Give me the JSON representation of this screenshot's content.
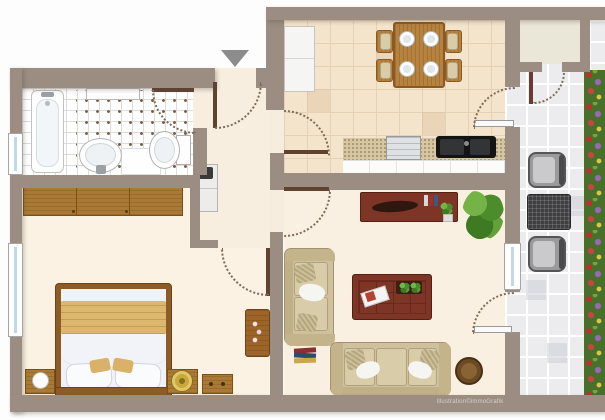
{
  "meta": {
    "type": "apartment-floor-plan",
    "watermark": "Illustration©immoGrafik",
    "entrance_marker": "down-arrow"
  },
  "palette": {
    "wall": "#9b8d81",
    "bathroom_tile": "#ffffff",
    "kitchen_floor": "#f5e4cc",
    "living_floor": "#faf0e1",
    "bedroom_floor": "#fbf2e4",
    "hallway_floor": "#f8eee0",
    "balcony_tile": "#ececef",
    "storage_niche_floor": "#eae6d8",
    "oak_wood": "#a97a35",
    "mahogany": "#7e3525",
    "sofa_fabric": "#cfc19d",
    "bed_blanket": "#dcb76e",
    "plant_green": "#4d8c2c",
    "door_leaf": "#5d4330",
    "window_glass": "#bdd9ea",
    "entrance_arrow": "#8c8c8c",
    "flower_colors": [
      "#b83232",
      "#9a68b8",
      "#d9c44c",
      "#49702a"
    ]
  },
  "rooms": [
    {
      "id": "bathroom",
      "fixtures": [
        "bathtub",
        "wash-basin",
        "toilet",
        "wall-shelf",
        "vanity",
        "window",
        "tiled-floor"
      ]
    },
    {
      "id": "hallway",
      "fixtures": [
        "entrance-door",
        "hallway-cabinet"
      ]
    },
    {
      "id": "kitchen-dining",
      "fixtures": [
        "dining-table",
        "dining-chair x4",
        "place-setting x4",
        "refrigerator",
        "counter",
        "stove",
        "sink",
        "balcony-door"
      ]
    },
    {
      "id": "living-room",
      "fixtures": [
        "sideboard",
        "houseplant",
        "loveseat",
        "sofa",
        "coffee-table",
        "round-side-table",
        "floor-books",
        "window",
        "balcony-door"
      ]
    },
    {
      "id": "bedroom",
      "fixtures": [
        "wardrobe",
        "double-bed",
        "nightstand x2",
        "bedside-lamp x2",
        "drawer-chest",
        "decor-table",
        "window"
      ]
    },
    {
      "id": "balcony",
      "fixtures": [
        "patio-chair x2",
        "patio-table",
        "flower-boxes",
        "storage-niche",
        "storage-door"
      ]
    }
  ],
  "doors": [
    "entrance-door",
    "bathroom-door",
    "kitchen-door",
    "living-room-door",
    "bedroom-door",
    "kitchen-balcony-door",
    "living-balcony-door",
    "storage-door"
  ],
  "windows": [
    "bathroom-window",
    "bedroom-window",
    "living-room-window"
  ]
}
